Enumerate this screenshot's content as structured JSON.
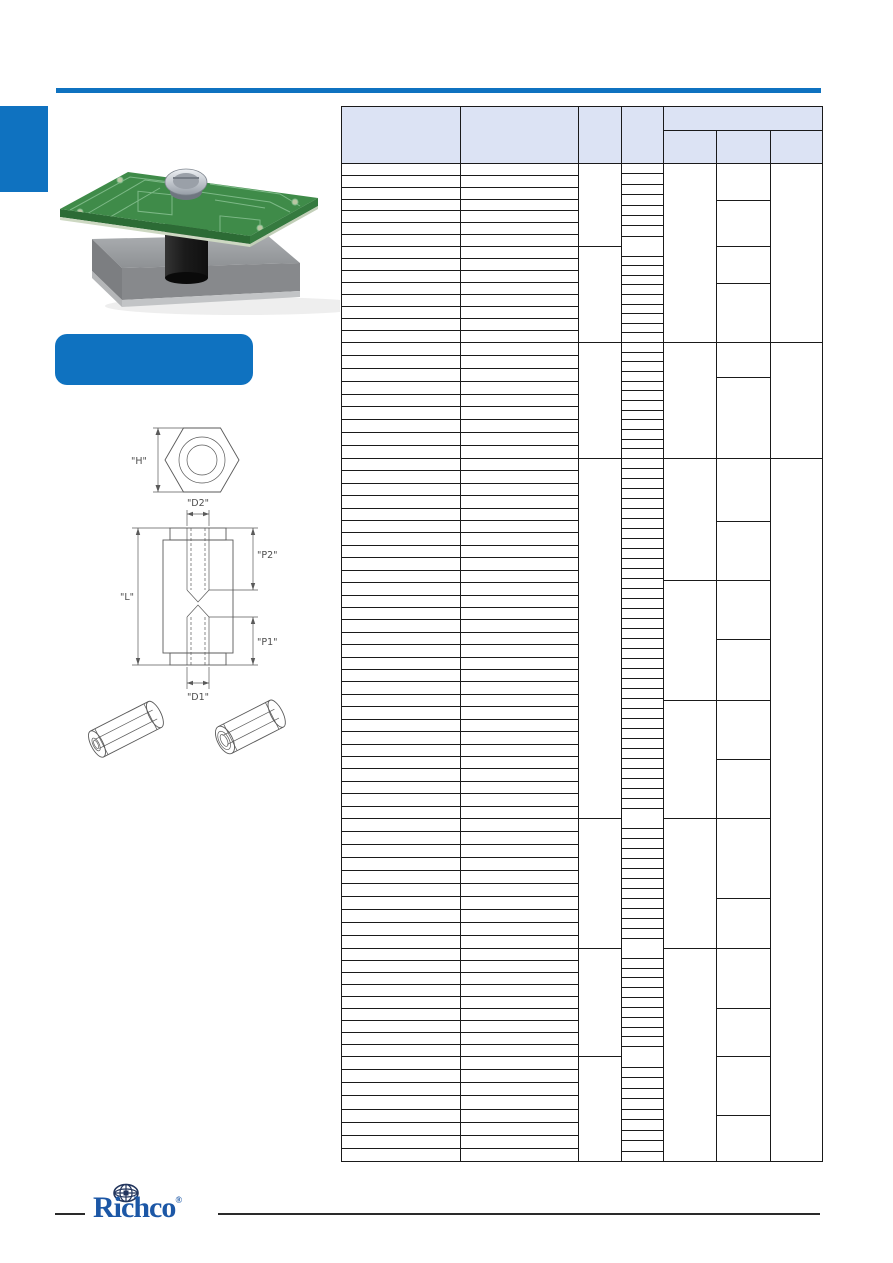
{
  "page": {
    "width": 893,
    "height": 1263,
    "background": "#ffffff"
  },
  "theme": {
    "accent_blue": "#0f72c0",
    "logo_blue": "#1c57a6",
    "header_fill": "#dce3f4",
    "grid_color": "#1a1a1a",
    "rule_color": "#2a2a2a",
    "drawing_stroke": "#5a5a5a",
    "label_color": "#4d4d4d"
  },
  "banner": {
    "label": ""
  },
  "diagram": {
    "labels": {
      "h": "\"H\"",
      "d2": "\"D2\"",
      "p2": "\"P2\"",
      "l": "\"L\"",
      "p1": "\"P1\"",
      "d1": "\"D1\""
    }
  },
  "footer": {
    "logo_text": "Richco",
    "registered_mark": "®"
  },
  "table": {
    "x_left": 341,
    "x_right": 822,
    "col_x": [
      341,
      460,
      578,
      621,
      663,
      716,
      770,
      822
    ],
    "header": {
      "top": 106,
      "group_split_y": 130,
      "bottom": 163,
      "column_headers": [
        "",
        "",
        "",
        ""
      ],
      "group_header": "",
      "sub_headers": [
        "",
        "",
        ""
      ]
    },
    "bottom": 1161,
    "v_lines": [
      [
        341,
        106,
        1161
      ],
      [
        460,
        106,
        1161
      ],
      [
        578,
        106,
        1161
      ],
      [
        621,
        106,
        1161
      ],
      [
        663,
        106,
        1161
      ],
      [
        716,
        130,
        1161
      ],
      [
        770,
        130,
        1161
      ],
      [
        822,
        106,
        1161
      ]
    ],
    "h_lines": [
      [
        106,
        341,
        822
      ],
      [
        130,
        663,
        822
      ],
      [
        163,
        341,
        822
      ],
      [
        200,
        716,
        770
      ],
      [
        246,
        341,
        621
      ],
      [
        246,
        716,
        770
      ],
      [
        283,
        716,
        770
      ],
      [
        342,
        341,
        822
      ],
      [
        377,
        716,
        770
      ],
      [
        458,
        341,
        822
      ],
      [
        521,
        716,
        770
      ],
      [
        580,
        663,
        770
      ],
      [
        639,
        716,
        770
      ],
      [
        700,
        663,
        770
      ],
      [
        759,
        716,
        770
      ],
      [
        818,
        341,
        621
      ],
      [
        818,
        663,
        770
      ],
      [
        898,
        716,
        770
      ],
      [
        948,
        341,
        621
      ],
      [
        948,
        663,
        770
      ],
      [
        1008,
        716,
        770
      ],
      [
        1056,
        341,
        621
      ],
      [
        1056,
        716,
        770
      ],
      [
        1115,
        716,
        770
      ],
      [
        1161,
        341,
        822
      ]
    ],
    "row_bands_cols12": [
      [
        163,
        246,
        7
      ],
      [
        246,
        342,
        8
      ],
      [
        342,
        458,
        9
      ],
      [
        458,
        818,
        29
      ],
      [
        818,
        948,
        10
      ],
      [
        948,
        1056,
        9
      ],
      [
        1056,
        1161,
        8
      ]
    ],
    "row_bands_col4": [
      [
        163,
        246,
        8
      ],
      [
        246,
        342,
        10
      ],
      [
        342,
        458,
        12
      ],
      [
        458,
        818,
        36
      ],
      [
        818,
        948,
        13
      ],
      [
        948,
        1056,
        11
      ],
      [
        1056,
        1161,
        10
      ]
    ]
  }
}
